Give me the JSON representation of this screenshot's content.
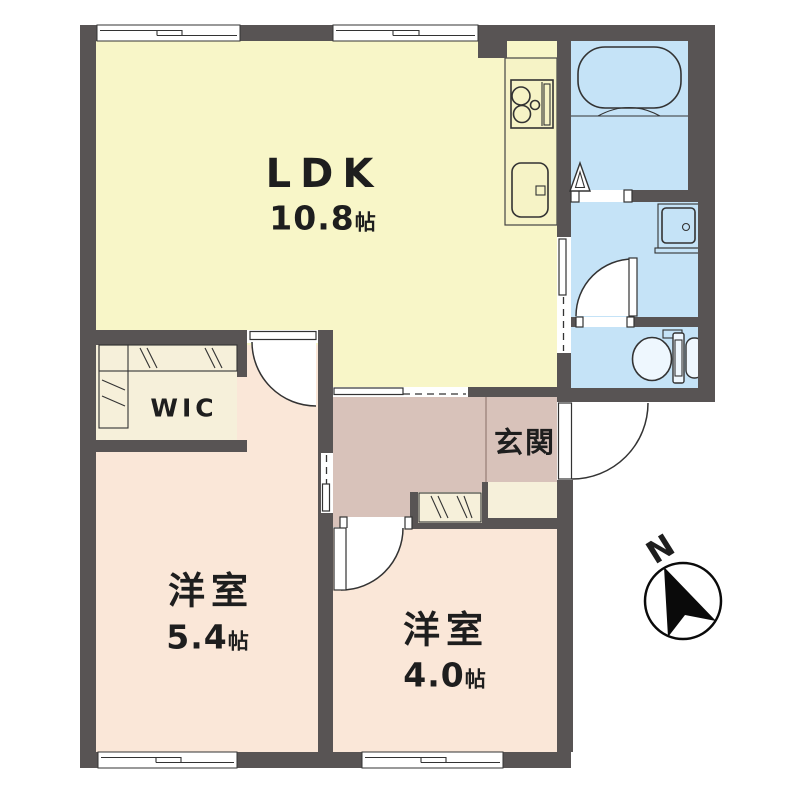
{
  "floor_plan": {
    "rooms": {
      "ldk": {
        "name": "LDK",
        "size_number": "10.8",
        "size_unit": "帖"
      },
      "wic": {
        "name": "WIC"
      },
      "entrance": {
        "name": "玄関"
      },
      "bedroom1": {
        "name": "洋室",
        "size_number": "5.4",
        "size_unit": "帖"
      },
      "bedroom2": {
        "name": "洋室",
        "size_number": "4.0",
        "size_unit": "帖"
      }
    },
    "compass": {
      "north_label": "N"
    },
    "colors": {
      "wall": "#585454",
      "ldk_yellow": "#f8f6c8",
      "bedroom_pink": "#fae7d8",
      "hall_mauve": "#d8c2ba",
      "storage_cream": "#f6f0da",
      "wet_area_blue": "#c5e3f7",
      "fixture_fill": "#e9f4fd",
      "line": "#333333"
    }
  }
}
